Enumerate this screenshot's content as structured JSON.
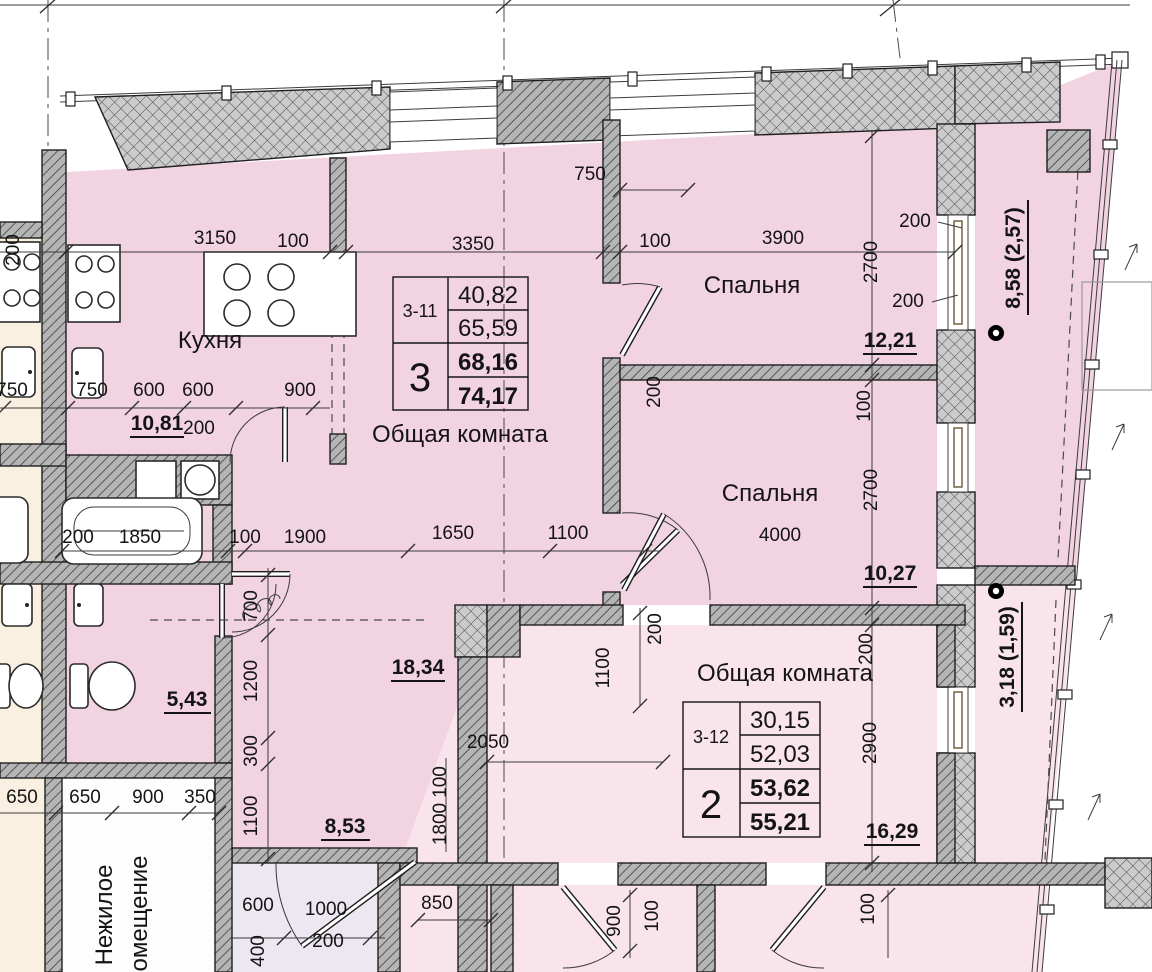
{
  "plan": {
    "rooms": {
      "kitchen": "Кухня",
      "living": "Общая комната",
      "bedroom1": "Спальня",
      "bedroom2": "Спальня",
      "living2": "Общая комната",
      "nonres1": "Нежилое",
      "nonres2": "помещение"
    },
    "apartments": [
      {
        "unit": "3-11",
        "rooms_count": "3",
        "areas": [
          "40,82",
          "65,59",
          "68,16",
          "74,17"
        ]
      },
      {
        "unit": "3-12",
        "rooms_count": "2",
        "areas": [
          "30,15",
          "52,03",
          "53,62",
          "55,21"
        ]
      }
    ],
    "areas": {
      "kitchen": "10,81",
      "bedroom1": "12,21",
      "bedroom2": "10,27",
      "hallway": "18,34",
      "bathroom": "5,43",
      "hall2": "8,53",
      "living2": "16,29",
      "balcony1": "8,58 (2,57)",
      "balcony2": "3,18 (1,59)"
    },
    "dims": [
      "3150",
      "100",
      "3350",
      "100",
      "3900",
      "750",
      "200",
      "200",
      "2700",
      "750",
      "750",
      "600",
      "600",
      "900",
      "200",
      "200",
      "200",
      "1850",
      "100",
      "1900",
      "1650",
      "1100",
      "200",
      "100",
      "2700",
      "4000",
      "700",
      "1200",
      "300",
      "1100",
      "1100",
      "200",
      "2050",
      "100",
      "1800",
      "2900",
      "200",
      "650",
      "650",
      "900",
      "350",
      "600",
      "1000",
      "200",
      "400",
      "850",
      "900",
      "100",
      "100"
    ],
    "colors": {
      "apartment1_fill": "#f2d3e2",
      "apartment2_fill": "#f8e4ea",
      "neighbor_fill": "#faf0e1",
      "storage_fill": "#ece7f0",
      "wall_fill": "#b5b5b5"
    }
  }
}
